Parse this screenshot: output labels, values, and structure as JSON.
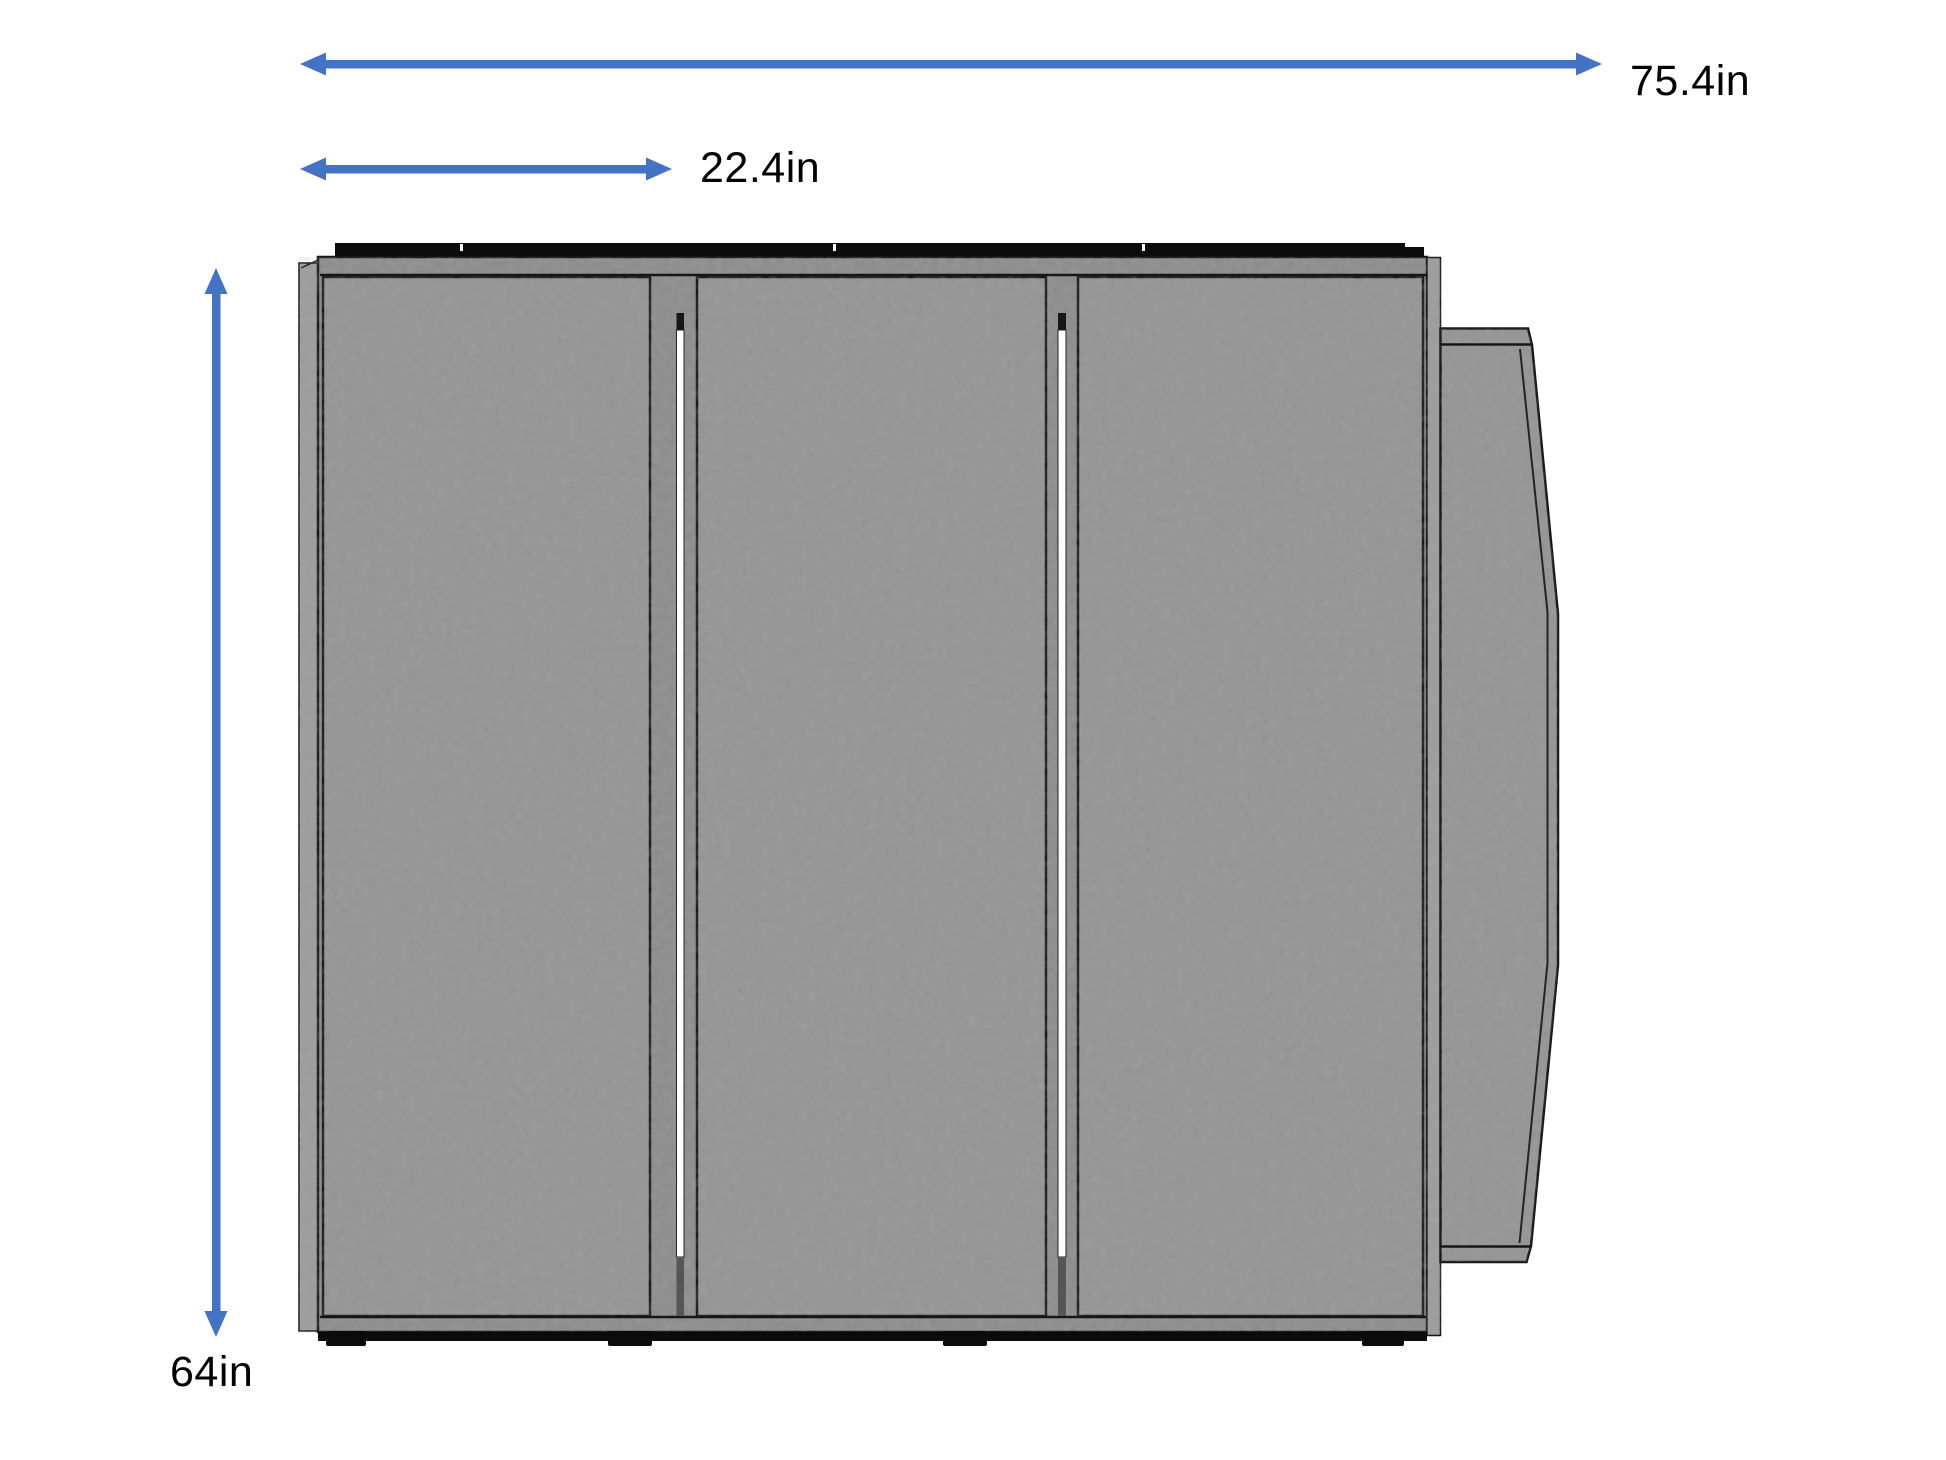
{
  "diagram": {
    "description": "Dimensioned front-view drawing of a three-panel cabinet bed with fold-down side leaf",
    "dimension_labels": {
      "overall_width": "75.4in",
      "section_width": "22.4in",
      "height": "64in"
    },
    "colors": {
      "dimension_arrow": "#4472c4",
      "label_text": "#030303",
      "panel_gray": "#949494",
      "frame_gray": "#8c8c8c",
      "edge_gray": "#9c9c9c",
      "wing_gray": "#949494",
      "outline_dark": "#161616",
      "top_strip_black": "#0b0b0b",
      "bottom_strip_black": "#0b0b0b",
      "gap_white": "#ffffff",
      "background": "#ffffff"
    }
  }
}
